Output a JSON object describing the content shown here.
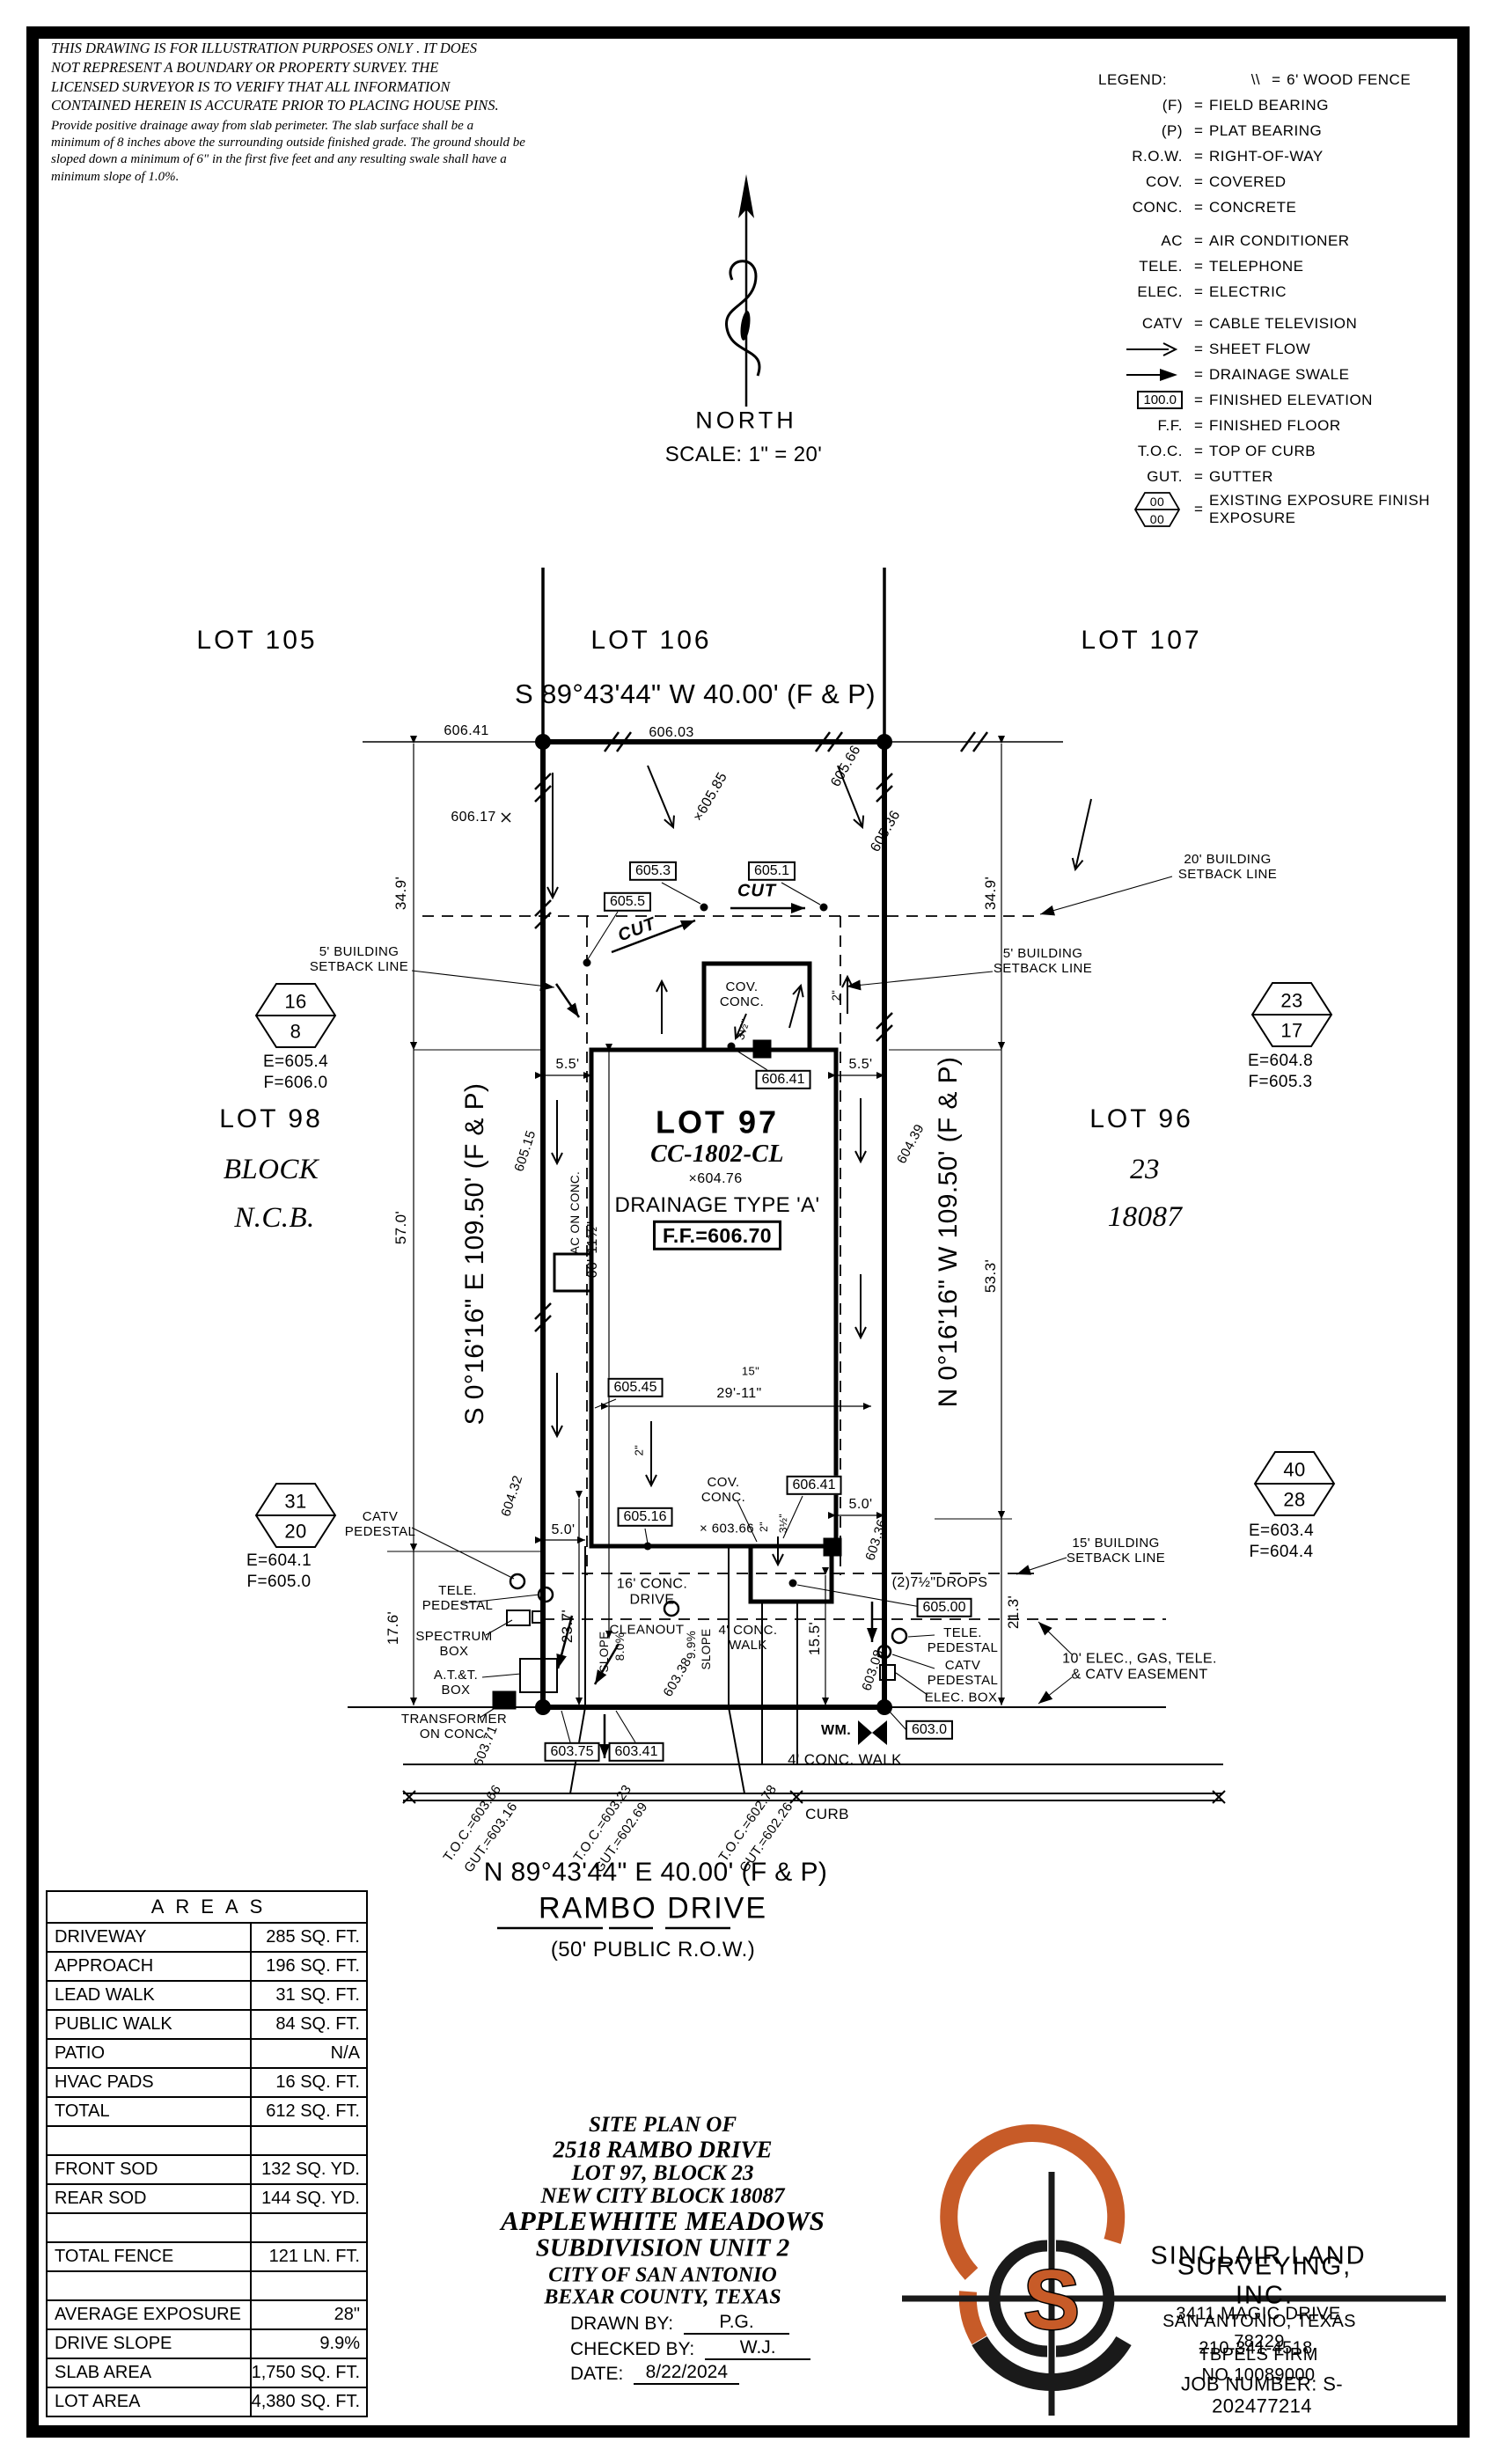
{
  "colors": {
    "accent": "#C75B28",
    "ink": "#000000"
  },
  "disclaimer": {
    "para1": "THIS DRAWING IS FOR ILLUSTRATION PURPOSES ONLY . IT DOES\nNOT REPRESENT A BOUNDARY OR PROPERTY SURVEY. THE\nLICENSED SURVEYOR IS TO VERIFY THAT ALL INFORMATION\nCONTAINED HEREIN IS ACCURATE PRIOR TO PLACING HOUSE PINS.",
    "para2": "Provide positive drainage away from slab perimeter. The slab surface shall be a\nminimum of 8 inches above the surrounding outside finished grade. The ground should be\nsloped down a minimum of 6\" in the first five feet and any resulting swale shall have a\nminimum slope of 1.0%."
  },
  "north": {
    "label": "NORTH",
    "scale": "SCALE:  1\" = 20'"
  },
  "legend": {
    "title": "LEGEND:",
    "eq": "=",
    "hex_top": "00",
    "hex_bottom": "00",
    "items": [
      {
        "sym": "\\\\",
        "desc": "6' WOOD FENCE"
      },
      {
        "sym": "(F)",
        "desc": "FIELD BEARING"
      },
      {
        "sym": "(P)",
        "desc": "PLAT BEARING"
      },
      {
        "sym": "R.O.W.",
        "desc": "RIGHT-OF-WAY"
      },
      {
        "sym": "COV.",
        "desc": "COVERED"
      },
      {
        "sym": "CONC.",
        "desc": "CONCRETE"
      },
      {
        "sym": "AC",
        "desc": "AIR CONDITIONER"
      },
      {
        "sym": "TELE.",
        "desc": "TELEPHONE"
      },
      {
        "sym": "ELEC.",
        "desc": "ELECTRIC"
      },
      {
        "sym": "CATV",
        "desc": "CABLE TELEVISION"
      },
      {
        "sym": "sheet-flow-arrow",
        "desc": "SHEET FLOW"
      },
      {
        "sym": "drainage-swale-arrow",
        "desc": "DRAINAGE SWALE"
      },
      {
        "sym": "100.0",
        "desc": "FINISHED ELEVATION"
      },
      {
        "sym": "F.F.",
        "desc": "FINISHED FLOOR"
      },
      {
        "sym": "T.O.C.",
        "desc": "TOP OF CURB"
      },
      {
        "sym": "GUT.",
        "desc": "GUTTER"
      },
      {
        "sym": "00/00",
        "desc": "EXISTING EXPOSURE\nFINISH EXPOSURE"
      }
    ]
  },
  "plat": {
    "lot105": "LOT 105",
    "lot106": "LOT 106",
    "lot107": "LOT 107",
    "lot98": "LOT 98",
    "block_word": "BLOCK",
    "ncb_word": "N.C.B.",
    "lot96": "LOT 96",
    "block_num": "23",
    "ncb_num": "18087",
    "bearing_top": "S 89°43'44\" W  40.00'  (F & P)",
    "bearing_left": "S 0°16'16\" E  109.50'  (F & P)",
    "bearing_right": "N 0°16'16\" W  109.50'  (F & P)",
    "bearing_bottom": "N 89°43'44\" E  40.00'  (F & P)",
    "street_name": "RAMBO DRIVE",
    "street_row": "(50' PUBLIC R.O.W.)",
    "house_lot": "LOT 97",
    "house_plan": "CC-1802-CL",
    "house_spot": "×604.76",
    "house_drainage": "DRAINAGE TYPE 'A'",
    "house_ff": "F.F.=606.70",
    "cov_conc_rear": "COV.\nCONC.",
    "cov_conc_front": "COV.\nCONC.",
    "ac_on_conc": "AC ON CONC.",
    "drive_label": "16' CONC.\nDRIVE",
    "lead_walk_label": "4' CONC.\nWALK",
    "public_walk_label": "4' CONC. WALK",
    "curb_label": "CURB",
    "cleanout": "CLEANOUT",
    "cut1": "CUT",
    "cut2": "CUT",
    "sb20": "20' BUILDING\nSETBACK LINE",
    "sb5_left": "5' BUILDING\nSETBACK LINE",
    "sb5_right": "5' BUILDING\nSETBACK LINE",
    "sb15": "15' BUILDING\nSETBACK LINE",
    "easement": "10' ELEC., GAS, TELE.\n& CATV EASEMENT",
    "drops": "(2)7½\"DROPS",
    "catv_ped_left": "CATV\nPEDESTAL",
    "tele_ped_left": "TELE.\nPEDESTAL",
    "spectrum_box": "SPECTRUM\nBOX",
    "att_box": "A.T.&T.\nBOX",
    "transformer": "TRANSFORMER\nON CONC.",
    "tele_ped_right": "TELE.\nPEDESTAL",
    "catv_ped_right": "CATV\nPEDESTAL",
    "elec_box": "ELEC. BOX",
    "wm": "WM.",
    "slope_left_word": "SLOPE",
    "slope_left_val": "8.0%",
    "slope_right_word": "SLOPE",
    "slope_right_val": "9.9%",
    "dims": {
      "d34_9_l": "34.9'",
      "d34_9_r": "34.9'",
      "d57_0": "57.0'",
      "d17_6": "17.6'",
      "d53_3": "53.3'",
      "d21_3": "21.3'",
      "d15_5": "15.5'",
      "d23_7": "23.7'",
      "d5_5_l": "5.5'",
      "d5_5_r": "5.5'",
      "d5_0_l": "5.0'",
      "d5_0_r": "5.0'",
      "d66_11": "66'-11½\"",
      "d29_11": "29'-11\"",
      "d15in": "15\"",
      "exp2_patio": "2\"",
      "exp2_front": "2\"",
      "exp2_walk": "2\"",
      "exp3_patio": "3½\"",
      "exp3_front": "3½\""
    },
    "spots": {
      "e606_41": "606.41",
      "e606_03": "606.03",
      "e606_17": "606.17",
      "e605_85": "×605.85",
      "e605_66": "605.66",
      "e605_36": "605.36",
      "e605_15": "605.15",
      "e604_32": "604.32",
      "e604_39": "604.39",
      "x603_66": "× 603.66",
      "e603_36": "603.36",
      "e603_08": "603.08",
      "e603_71": "603.71",
      "e603_38": "603.38"
    },
    "boxed": {
      "b605_3": "605.3",
      "b605_5": "605.5",
      "b605_1": "605.1",
      "b606_41_rear": "606.41",
      "b605_45": "605.45",
      "b605_16": "605.16",
      "b606_41_front": "606.41",
      "b605_00": "605.00",
      "b603_75": "603.75",
      "b603_41": "603.41",
      "b603_0": "603.0"
    },
    "toc": {
      "t1": "T.O.C.=603.66",
      "g1": "GUT.=603.16",
      "t2": "T.O.C.=603.23",
      "g2": "GUT.=602.69",
      "t3": "T.O.C.=602.78",
      "g3": "GUT.=602.26"
    },
    "callouts": {
      "c1": {
        "top": "16",
        "bottom": "8",
        "e": "E=605.4",
        "f": "F=606.0"
      },
      "c2": {
        "top": "23",
        "bottom": "17",
        "e": "E=604.8",
        "f": "F=605.3"
      },
      "c3": {
        "top": "31",
        "bottom": "20",
        "e": "E=604.1",
        "f": "F=605.0"
      },
      "c4": {
        "top": "40",
        "bottom": "28",
        "e": "E=603.4",
        "f": "F=604.4"
      }
    }
  },
  "areas": {
    "title": "AREAS",
    "rows": [
      {
        "label": "DRIVEWAY",
        "value": "285 SQ. FT."
      },
      {
        "label": "APPROACH",
        "value": "196 SQ. FT."
      },
      {
        "label": "LEAD WALK",
        "value": "31 SQ. FT."
      },
      {
        "label": "PUBLIC WALK",
        "value": "84 SQ. FT."
      },
      {
        "label": "PATIO",
        "value": "N/A"
      },
      {
        "label": "HVAC PADS",
        "value": "16 SQ. FT."
      },
      {
        "label": "TOTAL",
        "value": "612 SQ. FT."
      },
      {
        "label": "",
        "value": ""
      },
      {
        "label": "FRONT SOD",
        "value": "132 SQ. YD."
      },
      {
        "label": "REAR SOD",
        "value": "144 SQ. YD."
      },
      {
        "label": "",
        "value": ""
      },
      {
        "label": "TOTAL FENCE",
        "value": "121 LN. FT."
      },
      {
        "label": "",
        "value": ""
      },
      {
        "label": "AVERAGE EXPOSURE",
        "value": "28\""
      },
      {
        "label": "DRIVE SLOPE",
        "value": "9.9%"
      },
      {
        "label": "SLAB AREA",
        "value": "1,750 SQ. FT."
      },
      {
        "label": "LOT AREA",
        "value": "4,380 SQ. FT."
      }
    ]
  },
  "title_block": {
    "l1": "SITE PLAN OF",
    "l2": "2518 RAMBO DRIVE",
    "l3": "LOT 97, BLOCK 23",
    "l4": "NEW CITY BLOCK 18087",
    "l5": "APPLEWHITE MEADOWS",
    "l6": "SUBDIVISION UNIT 2",
    "l7": "CITY OF SAN ANTONIO",
    "l8": "BEXAR COUNTY, TEXAS",
    "drawn_label": "DRAWN BY:",
    "drawn_value": "P.G.",
    "checked_label": "CHECKED BY:",
    "checked_value": "W.J.",
    "date_label": "DATE:",
    "date_value": "8/22/2024"
  },
  "firm": {
    "logo_letter": "S",
    "name1": "SINCLAIR LAND",
    "name2": "SURVEYING, INC.",
    "addr1": "3411 MAGIC DRIVE",
    "addr2": "SAN ANTONIO, TEXAS 78229",
    "phone": "210-341-4518",
    "firm_no": "TBPELS FIRM NO.10089000",
    "job": "JOB NUMBER:  S-202477214"
  }
}
